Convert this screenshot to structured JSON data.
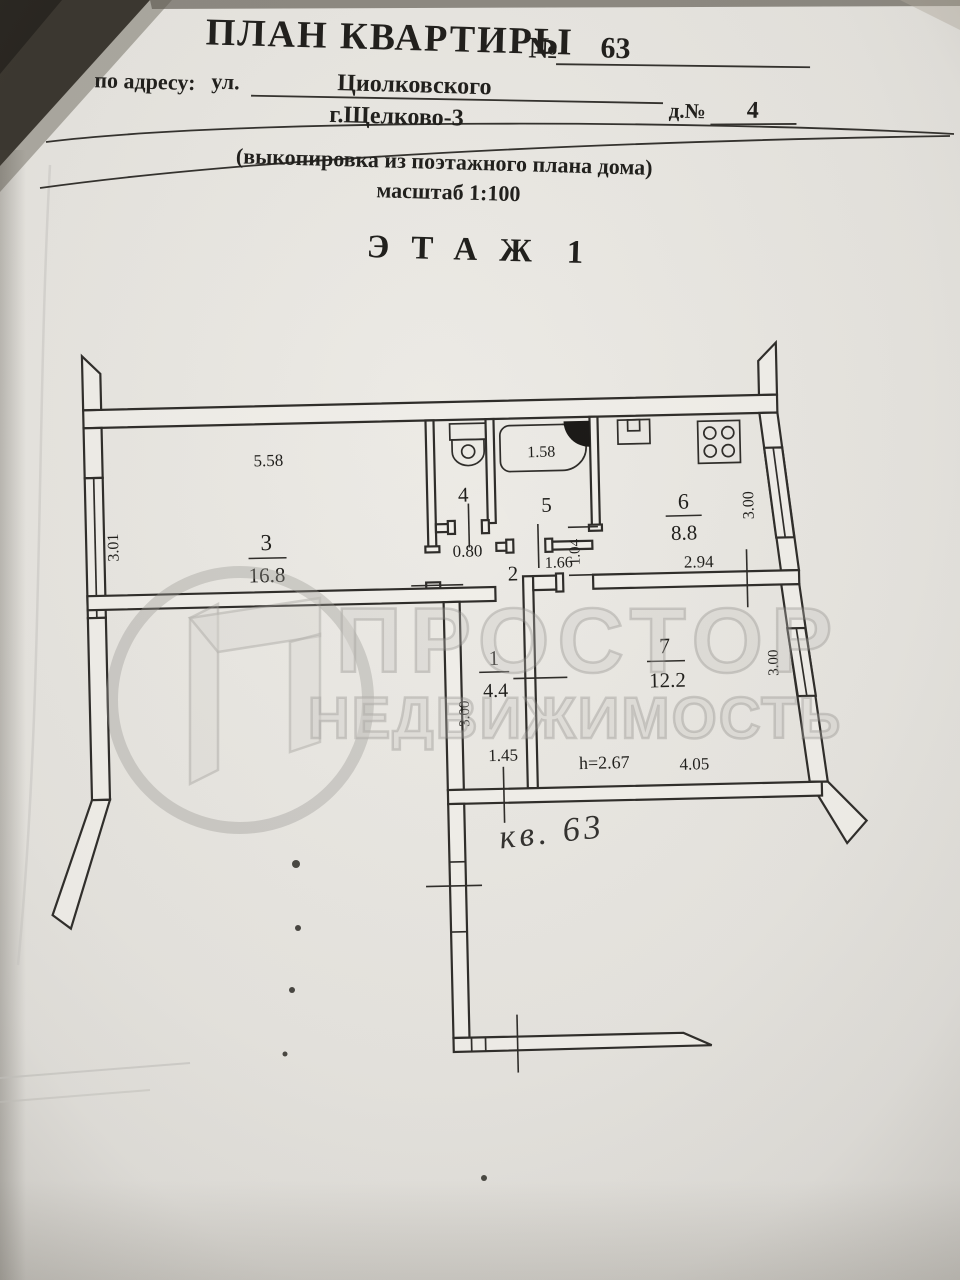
{
  "header": {
    "title": "ПЛАН КВАРТИРЫ",
    "number_sign": "№",
    "apartment_number": "63",
    "address_label": "по адресу:",
    "street_label": "ул.",
    "street": "Циолковского",
    "city": "г.Щелково-3",
    "house_label": "д.№",
    "house_number": "4",
    "subtitle": "(выкопировка из поэтажного плана дома)",
    "scale": "масштаб  1:100",
    "floor_label": "ЭТАЖ",
    "floor_number": "1"
  },
  "plan": {
    "rooms": {
      "living": {
        "number": "3",
        "area": "16.8"
      },
      "wc": {
        "number": "4"
      },
      "bathroom": {
        "number": "5"
      },
      "kitchen": {
        "number": "6",
        "area": "8.8"
      },
      "corridor": {
        "number": "2"
      },
      "hall": {
        "number": "1",
        "area": "4.4"
      },
      "room7": {
        "number": "7",
        "area": "12.2"
      }
    },
    "dimensions": {
      "room3_width": "5.58",
      "room3_depth": "3.01",
      "wc_door_width": "0.80",
      "bath_length": "1.58",
      "bathroom_width": "1.66",
      "kitchen_doorway": "1.04",
      "kitchen_width": "2.94",
      "kitchen_depth": "3.00",
      "hall_width": "1.45",
      "hall_depth": "3.00",
      "room7_width": "4.05",
      "room7_depth": "3.00",
      "ceiling_height": "h=2.67"
    }
  },
  "annotation": {
    "handwritten": "кв. 63"
  },
  "watermark": {
    "line1": "ПРОСТОР",
    "line2": "НЕДВИЖИМОСТЬ"
  },
  "colors": {
    "ink": "#2f2d2a",
    "paper": "#e8e6e1",
    "watermark": "#a8a6a2"
  }
}
